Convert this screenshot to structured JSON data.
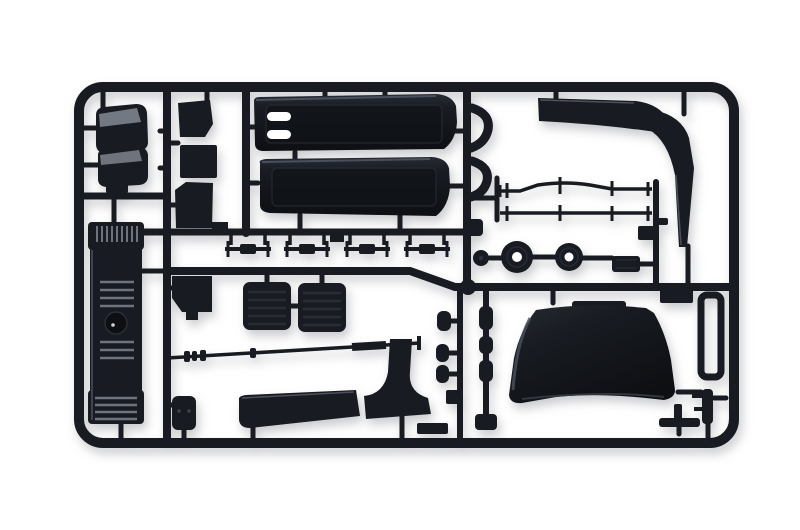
{
  "scene": {
    "type": "product-photograph",
    "subject": "Plastic model-kit sprue (parts tree) with unassembled truck parts",
    "description": "Photograph of a dark blue-black injection-moulded sprue frame holding scale truck model parts on a plain white background",
    "background": "plain white"
  },
  "colors": {
    "background": "#ffffff",
    "plastic": "#181b21",
    "plastic-deep": "#0d0f13",
    "plastic-soft": "#262b33",
    "edge-highlight": "#4a515c",
    "metal-highlight": "#848a94",
    "slat-highlight": "#6e747e",
    "recess": "#101318",
    "shadow": "rgba(150,152,158,0.5)"
  },
  "parts": [
    {
      "name": "Sprue frame"
    },
    {
      "name": "Runner rails"
    },
    {
      "name": "Fender shell (upper)"
    },
    {
      "name": "Fender shell (lower)"
    },
    {
      "name": "Front grille panel"
    },
    {
      "name": "Small box part"
    },
    {
      "name": "Medium box part"
    },
    {
      "name": "Angled bracket part"
    },
    {
      "name": "Side fairing panel with slots"
    },
    {
      "name": "Side fairing panel (plain)"
    },
    {
      "name": "Roof corner deflector"
    },
    {
      "name": "Window deflector (upper)"
    },
    {
      "name": "Window deflector (lower)"
    },
    {
      "name": "Chassis rod (upper)"
    },
    {
      "name": "Chassis rod (lower)"
    },
    {
      "name": "Wheel disc (large)"
    },
    {
      "name": "Wheel disc (small)"
    },
    {
      "name": "Small disc fitting"
    },
    {
      "name": "Axle mount block"
    },
    {
      "name": "Leaf spring set"
    },
    {
      "name": "Seat cushion (left)"
    },
    {
      "name": "Seat cushion (right)"
    },
    {
      "name": "Step flap"
    },
    {
      "name": "Drive shaft"
    },
    {
      "name": "Small tank"
    },
    {
      "name": "Front spoiler blade"
    },
    {
      "name": "Front spoiler corner piece"
    },
    {
      "name": "Roof air dam"
    },
    {
      "name": "Shock absorber fittings"
    },
    {
      "name": "Runner loop"
    },
    {
      "name": "Right-edge bracket fitting"
    },
    {
      "name": "Tee fitting"
    },
    {
      "name": "Knob fitting"
    },
    {
      "name": "Frame end block"
    }
  ]
}
